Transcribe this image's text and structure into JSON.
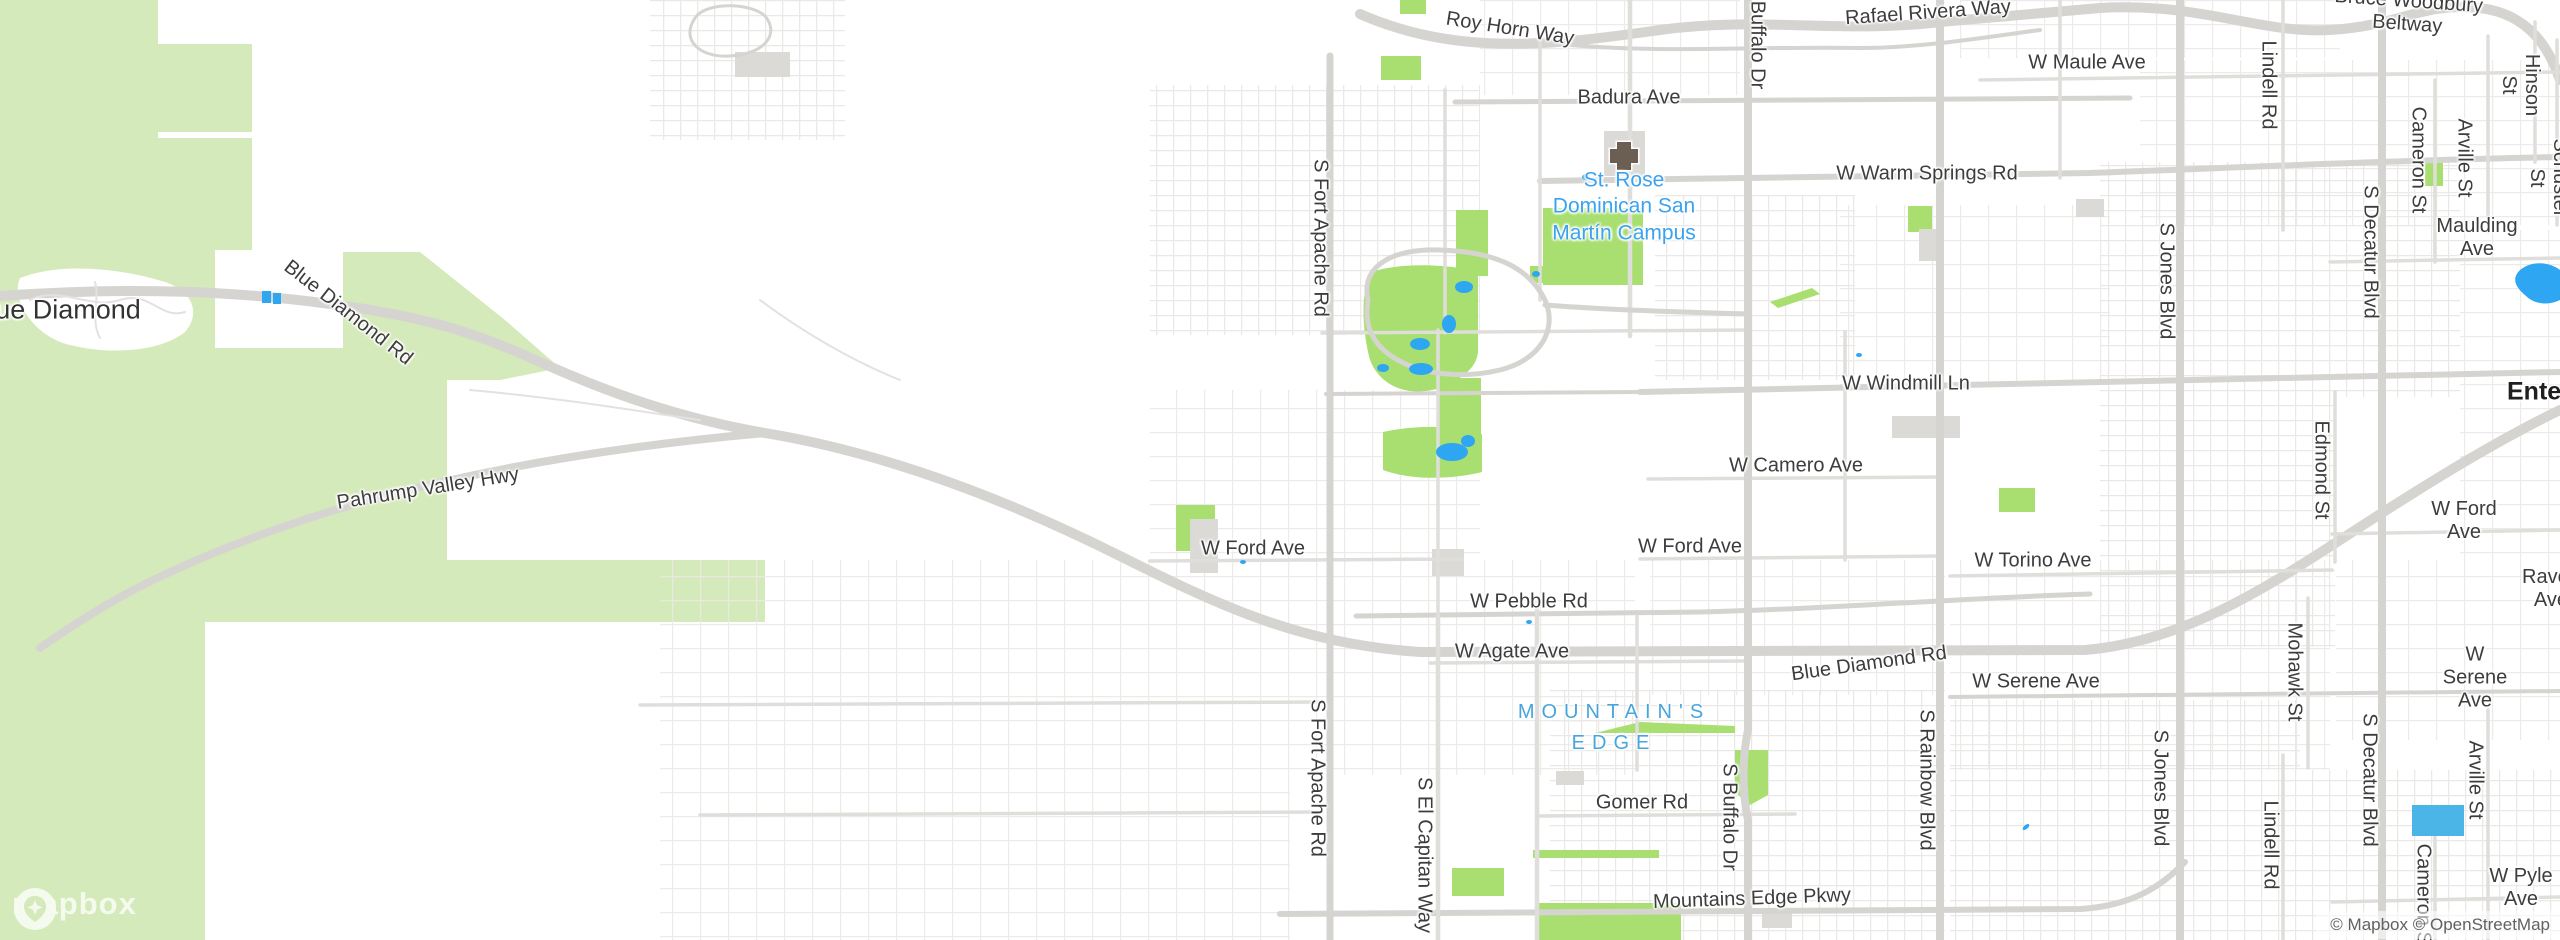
{
  "map": {
    "logo_text": "mapbox",
    "attribution": "© Mapbox © OpenStreetMap",
    "icons": {
      "hospital": "hospital-cross-icon",
      "logo_pin": "mapbox-pin-icon"
    },
    "colors": {
      "land": "#ffffff",
      "terrain_green": "#d5eaba",
      "park_green": "#a8df70",
      "water": "#2ea6f1",
      "water_light": "#4cb5e8",
      "road_major": "#d6d4d1",
      "road_minor": "#e8e7e5",
      "building": "#dcdad7",
      "label_dark": "#3d3d3d",
      "poi_blue": "#3ba2ef",
      "area_blue": "#47a5dc"
    },
    "labels": [
      {
        "t": "Roy Horn Way",
        "x": 1510,
        "y": 29,
        "r": 9
      },
      {
        "t": "Rafael Rivera Way",
        "x": 1928,
        "y": 13,
        "r": -4
      },
      {
        "t": "Bruce Woodbury Beltway",
        "x": 2408,
        "y": 13,
        "r": 4
      },
      {
        "t": "Badura Ave",
        "x": 1629,
        "y": 98
      },
      {
        "t": "W Maule Ave",
        "x": 2087,
        "y": 63
      },
      {
        "t": "W Warm Springs Rd",
        "x": 1927,
        "y": 174
      },
      {
        "t": "Maulding Ave",
        "x": 2477,
        "y": 238
      },
      {
        "t": "W Windmill Ln",
        "x": 1906,
        "y": 384
      },
      {
        "t": "W Camero Ave",
        "x": 1796,
        "y": 466
      },
      {
        "t": "W Ford Ave",
        "x": 1253,
        "y": 549
      },
      {
        "t": "W Ford Ave",
        "x": 1690,
        "y": 547
      },
      {
        "t": "W Ford Ave",
        "x": 2464,
        "y": 521
      },
      {
        "t": "W Torino Ave",
        "x": 2033,
        "y": 561
      },
      {
        "t": "W Pebble Rd",
        "x": 1529,
        "y": 602
      },
      {
        "t": "W Agate Ave",
        "x": 1512,
        "y": 652
      },
      {
        "t": "Blue Diamond Rd",
        "x": 1869,
        "y": 664,
        "r": -8
      },
      {
        "t": "W Serene Ave",
        "x": 2036,
        "y": 682
      },
      {
        "t": "W Serene Ave",
        "x": 2475,
        "y": 678
      },
      {
        "t": "Raven Ave",
        "x": 2522,
        "y": 589,
        "ax": "left"
      },
      {
        "t": "Gomer Rd",
        "x": 1642,
        "y": 803
      },
      {
        "t": "Mountains Edge Pkwy",
        "x": 1752,
        "y": 899,
        "r": -2
      },
      {
        "t": "W Pyle Ave",
        "x": 2482,
        "y": 888,
        "ax": "left"
      },
      {
        "t": "Blue Diamond",
        "x": 56,
        "y": 310,
        "c": "town"
      },
      {
        "t": "Blue Diamond Rd",
        "x": 348,
        "y": 313,
        "r": 38
      },
      {
        "t": "Pahrump Valley Hwy",
        "x": 428,
        "y": 489,
        "r": -9
      },
      {
        "t": "Buffalo Dr",
        "x": 1757,
        "y": 45,
        "r": 90
      },
      {
        "t": "S Fort Apache Rd",
        "x": 1320,
        "y": 238,
        "r": 90
      },
      {
        "t": "S Fort Apache Rd",
        "x": 1317,
        "y": 778,
        "r": 90
      },
      {
        "t": "S El Capitan Way",
        "x": 1424,
        "y": 855,
        "r": 90
      },
      {
        "t": "S Buffalo Dr",
        "x": 1729,
        "y": 817,
        "r": 90
      },
      {
        "t": "S Jones Blvd",
        "x": 2166,
        "y": 281,
        "r": 90
      },
      {
        "t": "S Jones Blvd",
        "x": 2160,
        "y": 788,
        "r": 90
      },
      {
        "t": "S Rainbow Blvd",
        "x": 1926,
        "y": 780,
        "r": 90
      },
      {
        "t": "S Decatur Blvd",
        "x": 2370,
        "y": 252,
        "r": 90
      },
      {
        "t": "S Decatur Blvd",
        "x": 2369,
        "y": 780,
        "r": 90
      },
      {
        "t": "Lindell Rd",
        "x": 2268,
        "y": 85,
        "r": 90
      },
      {
        "t": "Lindell Rd",
        "x": 2270,
        "y": 845,
        "r": 90
      },
      {
        "t": "Edmond St",
        "x": 2321,
        "y": 470,
        "r": 90
      },
      {
        "t": "Mohawk St",
        "x": 2294,
        "y": 672,
        "r": 90
      },
      {
        "t": "Arville St",
        "x": 2464,
        "y": 158,
        "r": 90
      },
      {
        "t": "Arville St",
        "x": 2475,
        "y": 780,
        "r": 90
      },
      {
        "t": "Cameron St",
        "x": 2418,
        "y": 160,
        "r": 90
      },
      {
        "t": "Cameron St",
        "x": 2423,
        "y": 897,
        "r": 90
      },
      {
        "t": "Hinson St",
        "x": 2520,
        "y": 85,
        "r": 90
      },
      {
        "t": "Schuster St",
        "x": 2548,
        "y": 178,
        "r": 90
      },
      {
        "t": "St. Rose\nDominican San\nMartín Campus",
        "x": 1624,
        "y": 207,
        "c": "poi"
      },
      {
        "t": "MOUNTAIN'S\nEDGE",
        "x": 1614,
        "y": 728,
        "c": "area"
      },
      {
        "t": "Enterprise",
        "x": 2507,
        "y": 392,
        "ax": "left",
        "c": "place"
      }
    ]
  }
}
